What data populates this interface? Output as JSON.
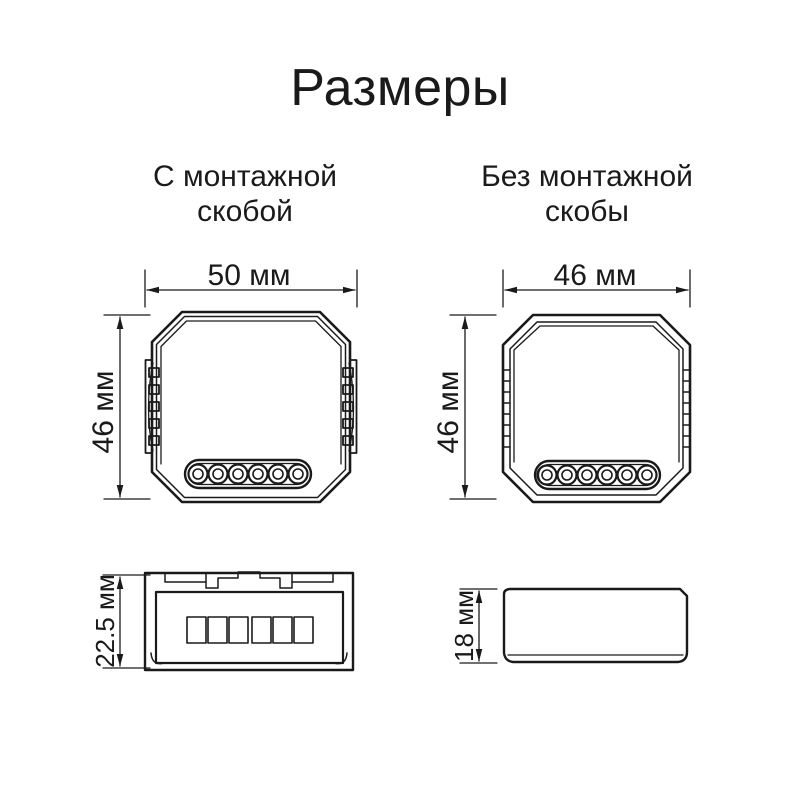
{
  "page": {
    "title": "Размеры",
    "background_color": "#ffffff",
    "line_color": "#1a1a1a"
  },
  "with_bracket": {
    "subtitle_line1": "С монтажной",
    "subtitle_line2": "скобой",
    "top_view": {
      "width_label": "50 мм",
      "height_label": "46 мм",
      "terminal_count": 6
    },
    "side_view": {
      "height_label": "22.5 мм",
      "terminal_slot_count": 6
    }
  },
  "without_bracket": {
    "subtitle_line1": "Без монтажной",
    "subtitle_line2": "скобы",
    "top_view": {
      "width_label": "46 мм",
      "height_label": "46 мм",
      "terminal_count": 6
    },
    "side_view": {
      "height_label": "18 мм"
    }
  }
}
